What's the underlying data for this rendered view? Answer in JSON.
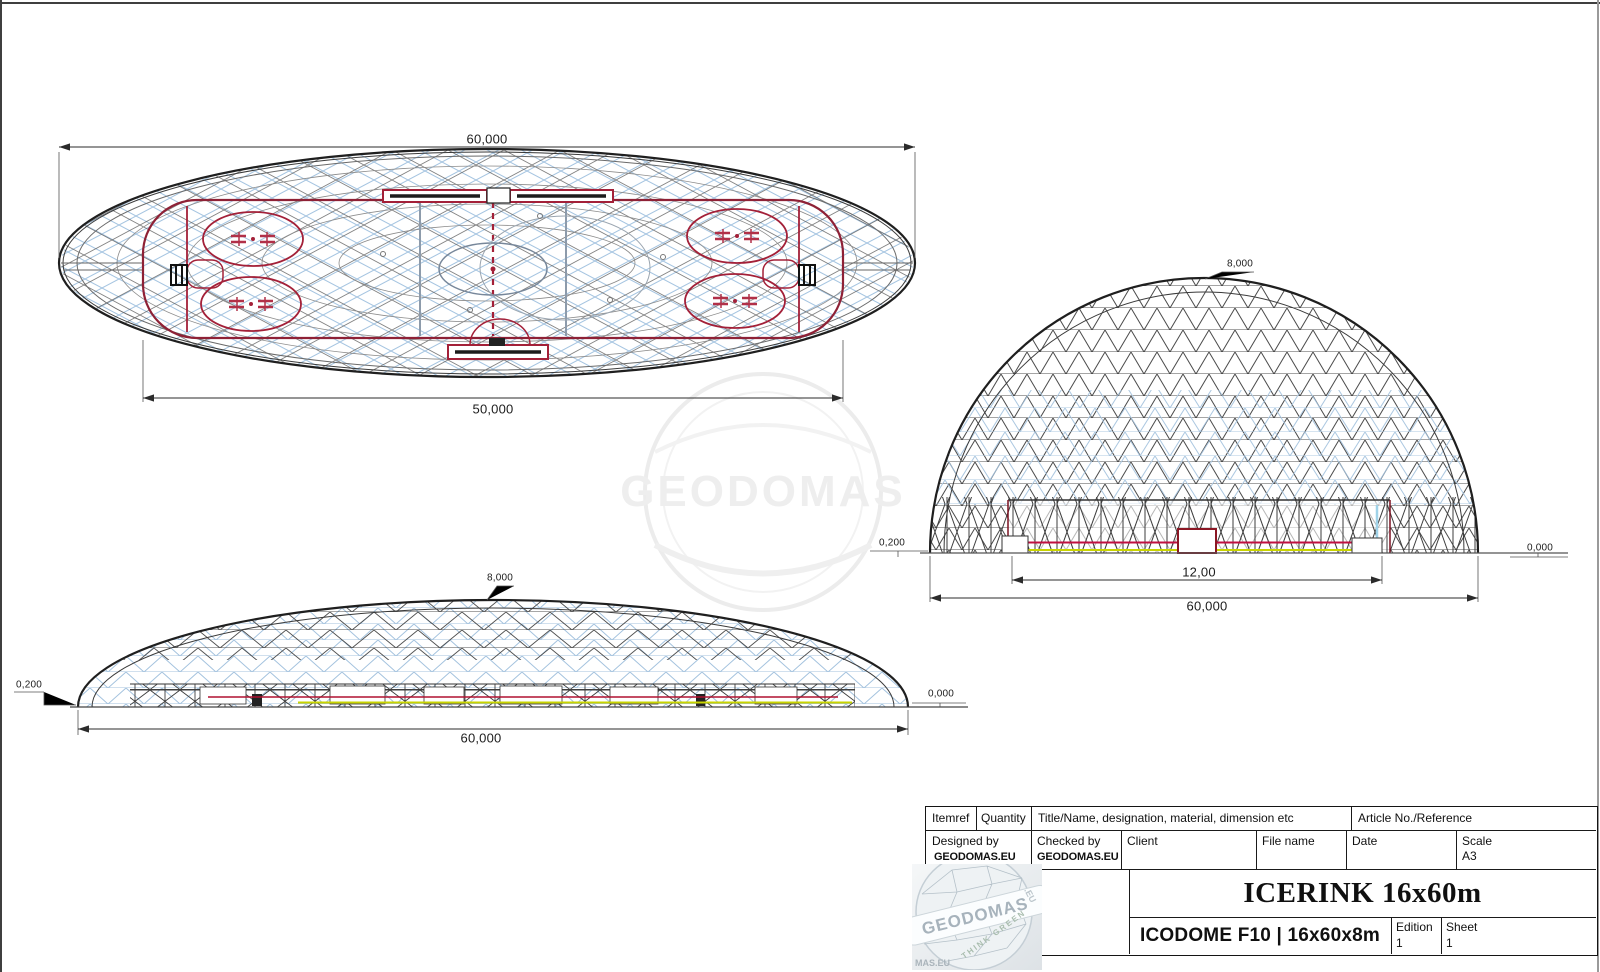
{
  "watermark": {
    "text": "GEODOMAS"
  },
  "colors": {
    "mesh_blue": "#a6c5e1",
    "mesh_dark": "#4b4b4b",
    "rink_red": "#a32038",
    "line_red": "#c01040",
    "line_yellow": "#c9d400",
    "outline": "#1f1f1f"
  },
  "plan_view": {
    "dim_width": "60,000",
    "dim_rink_length": "50,000"
  },
  "end_elevation": {
    "dim_height": "8,000",
    "dim_base_left": "0,200",
    "dim_base_right": "0,000",
    "dim_inner_width": "12,00",
    "dim_total_width": "60,000"
  },
  "side_elevation": {
    "dim_height": "8,000",
    "dim_base_left": "0,200",
    "dim_base_right": "0,000",
    "dim_total_width": "60,000"
  },
  "title_block": {
    "itemref_label": "Itemref",
    "quantity_label": "Quantity",
    "titlename_label": "Title/Name, designation, material, dimension etc",
    "article_label": "Article No./Reference",
    "designed_by_label": "Designed by",
    "designed_by_value": "GEODOMAS.EU",
    "checked_by_label": "Checked by",
    "checked_by_value": "GEODOMAS.EU",
    "client_label": "Client",
    "file_name_label": "File name",
    "date_label": "Date",
    "scale_label": "Scale",
    "scale_value": "A3",
    "drawing_title": "ICERINK 16x60m",
    "drawing_subtitle": "ICODOME F10 | 16x60x8m",
    "edition_label": "Edition",
    "edition_value": "1",
    "sheet_label": "Sheet",
    "sheet_value": "1"
  },
  "logo": {
    "band_text": "GEODOMAS",
    "eu_text": ".EU",
    "tagline": "THINK GREEN",
    "corner_text": "MAS.EU"
  }
}
